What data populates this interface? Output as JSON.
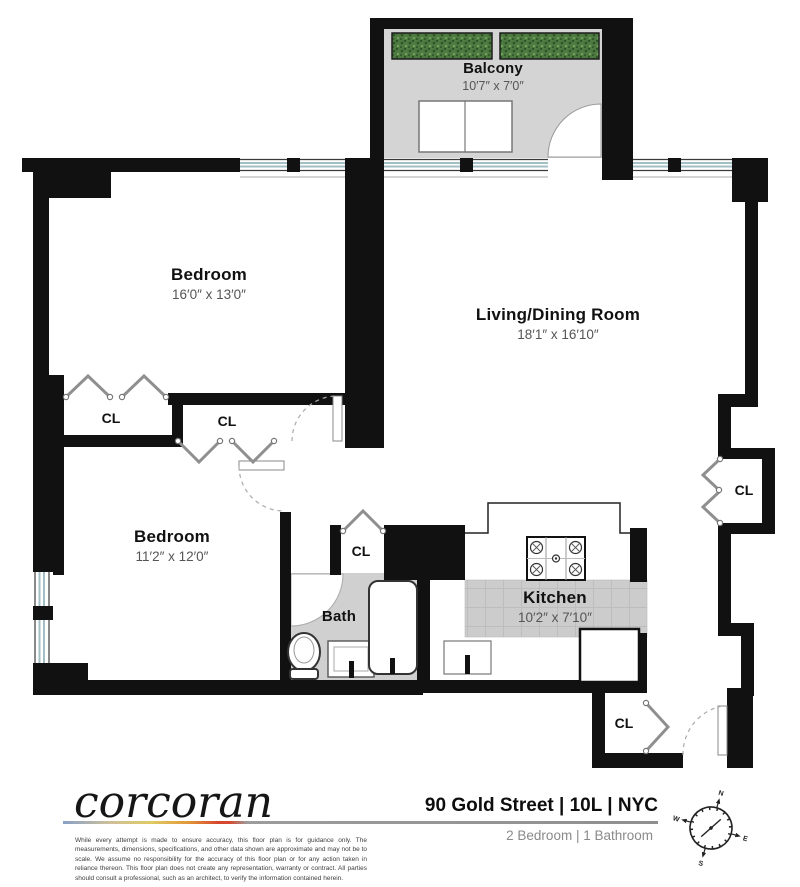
{
  "plan": {
    "rooms": [
      {
        "id": "balcony",
        "name": "Balcony",
        "dims": "10′7″ x 7′0″"
      },
      {
        "id": "bedroom-top",
        "name": "Bedroom",
        "dims": "16′0″ x 13′0″"
      },
      {
        "id": "living-dining",
        "name": "Living/Dining Room",
        "dims": "18′1″ x 16′10″"
      },
      {
        "id": "bedroom-bottom",
        "name": "Bedroom",
        "dims": "11′2″ x 12′0″"
      },
      {
        "id": "bath",
        "name": "Bath",
        "dims": ""
      },
      {
        "id": "kitchen",
        "name": "Kitchen",
        "dims": "10′2″ x 7′10″"
      }
    ],
    "closets": [
      {
        "label": "CL"
      },
      {
        "label": "CL"
      },
      {
        "label": "CL"
      },
      {
        "label": "CL"
      },
      {
        "label": "CL"
      }
    ]
  },
  "footer": {
    "brand": "corcoran",
    "address": "90 Gold Street | 10L | NYC",
    "summary": "2 Bedroom | 1 Bathroom",
    "disclaimer": "While every attempt is made to ensure accuracy, this floor plan is for guidance only. The measurements, dimensions, specifications, and other data shown are approximate and may not be to scale. We assume no responsibility for the accuracy of this floor plan or for any action taken in reliance thereon. This floor plan does not create any representation, warranty or contract. All parties should consult a professional, such as an architect, to verify the information contained herein.",
    "compass": {
      "n": "N",
      "e": "E",
      "s": "S",
      "w": "W"
    }
  },
  "colors": {
    "wall": "#111111",
    "balcony_floor": "#d4d4d4",
    "bath_floor": "#d0d0d0",
    "kitchen_counter": "#cccccc",
    "planter_green": "#4d7a40",
    "window_glass": "#a3bfc6",
    "north_red": "#b03a2e",
    "brand_gradient": [
      "#88a0c6",
      "#dfca62",
      "#e2983a",
      "#d6482e",
      "#9c9c9c"
    ]
  }
}
